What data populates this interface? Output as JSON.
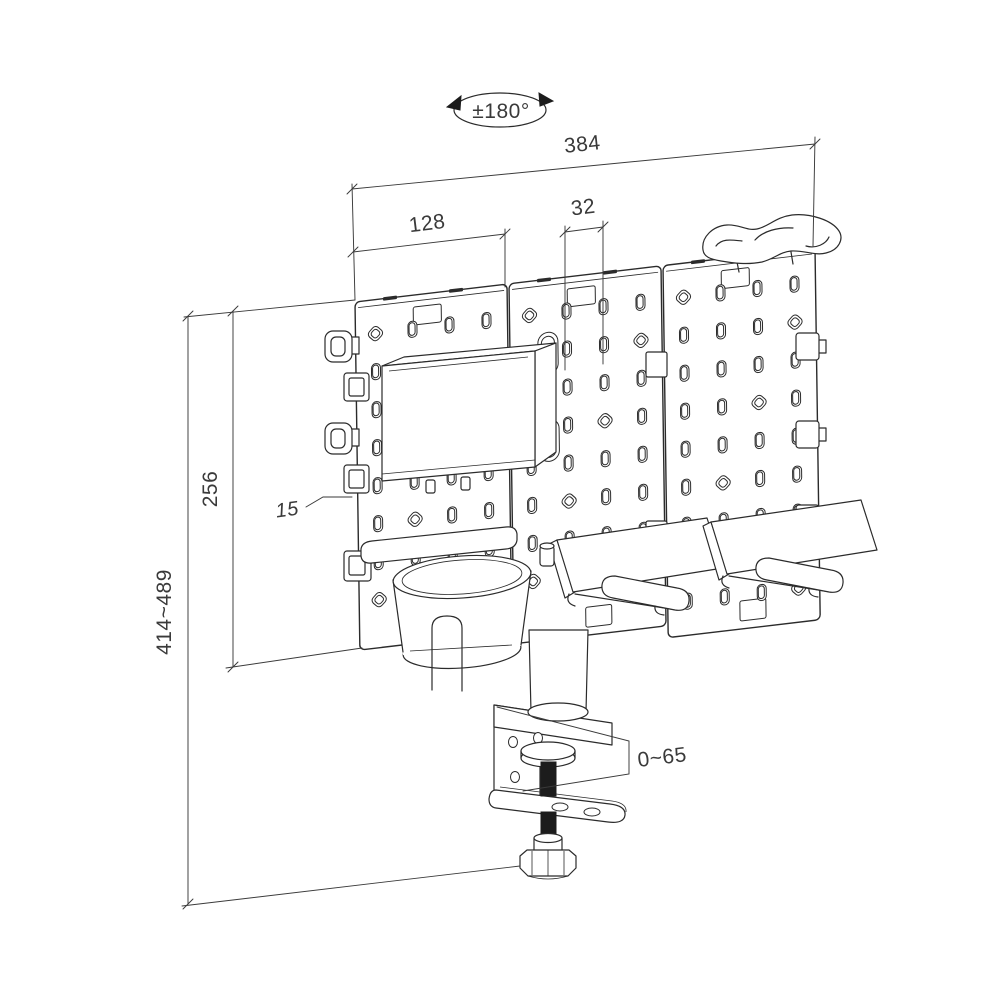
{
  "drawing": {
    "title": "pegboard-desk-mount-dimension-drawing",
    "rotation_label": "±180°",
    "total_width": "384",
    "left_panel_width": "128",
    "hole_pitch": "32",
    "panel_height": "256",
    "overall_height": "414~489",
    "panel_thickness": "15",
    "clamp_range": "0~65",
    "line_color": "#2b2b2b",
    "dim_color": "#3a3a3a",
    "background": "#ffffff"
  }
}
